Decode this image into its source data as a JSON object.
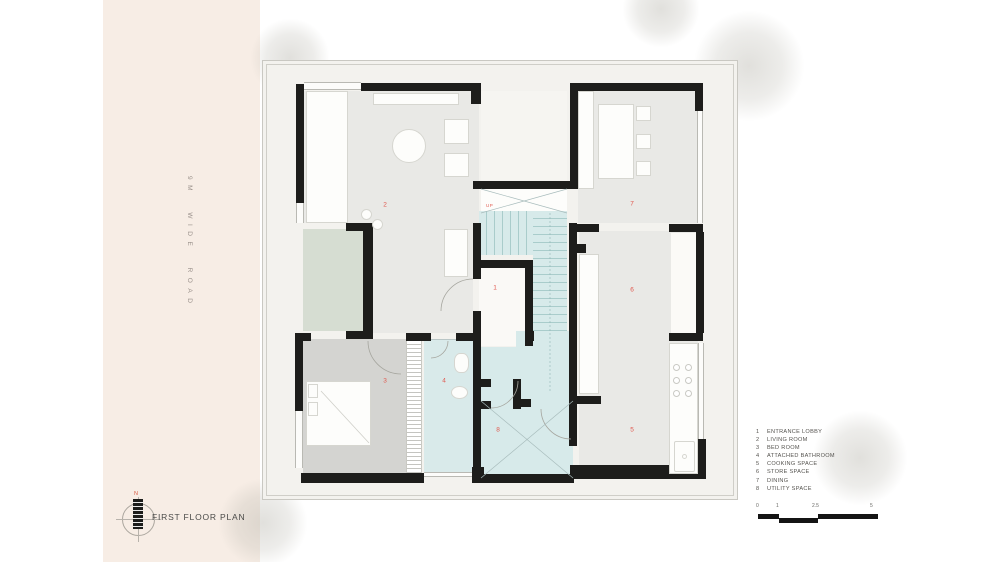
{
  "road": {
    "label": "9M WIDE ROAD"
  },
  "title_block": {
    "title": "FIRST FLOOR PLAN",
    "north": "N"
  },
  "plan": {
    "up_label": "UP"
  },
  "rooms": [
    {
      "number": "1",
      "name": "ENTRANCE LOBBY"
    },
    {
      "number": "2",
      "name": "LIVING ROOM"
    },
    {
      "number": "3",
      "name": "BED ROOM"
    },
    {
      "number": "4",
      "name": "ATTACHED BATHROOM"
    },
    {
      "number": "5",
      "name": "COOKING SPACE"
    },
    {
      "number": "6",
      "name": "STORE SPACE"
    },
    {
      "number": "7",
      "name": "DINING"
    },
    {
      "number": "8",
      "name": "UTILITY SPACE"
    }
  ],
  "scale_bar": {
    "labels": [
      "0",
      "1",
      "2.5",
      "5"
    ]
  },
  "colors": {
    "wall": "#1d1d1b",
    "room_number_accent": "#e0584e",
    "road_background": "#f7ede5",
    "floor": "#e9e9e6",
    "bedroom_floor": "#d4d4d1",
    "wet_area_floor": "#d7eaea",
    "planter_green": "#d6ddd2"
  }
}
